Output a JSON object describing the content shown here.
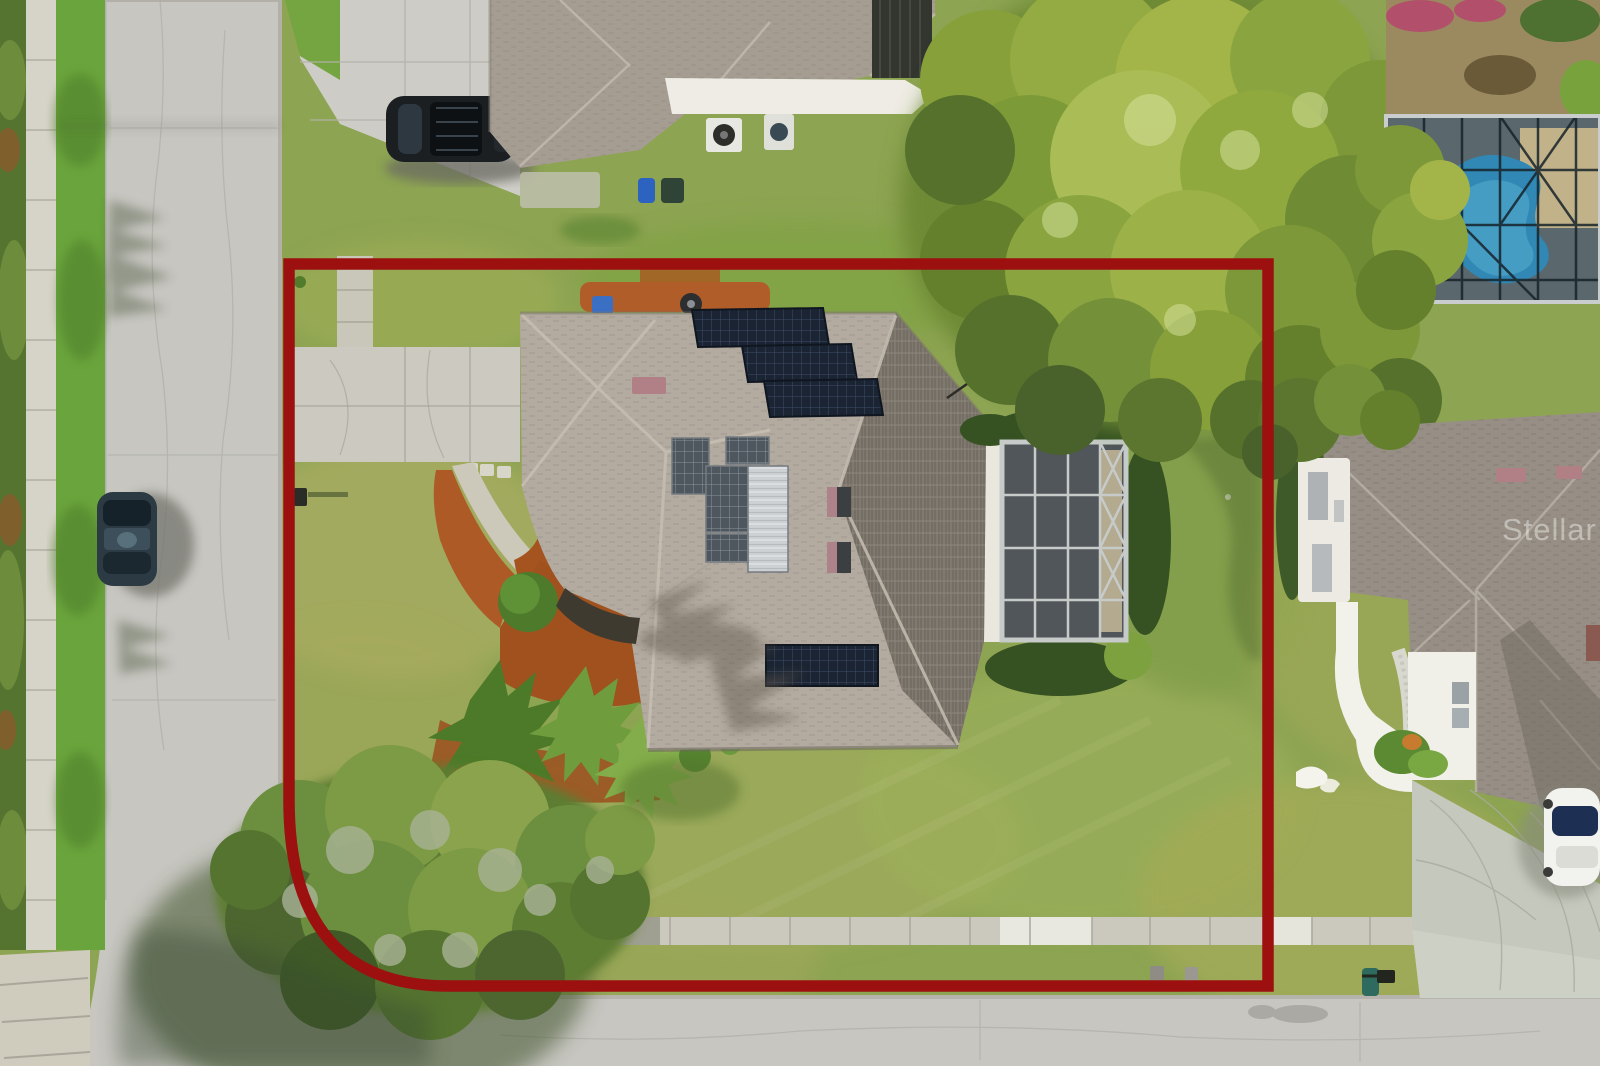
{
  "image": {
    "kind": "aerial-drone-photograph",
    "subject": "residential corner lot with highlighted property boundary",
    "width_px": 1600,
    "height_px": 1066
  },
  "watermark": {
    "text": "Stellar MLS",
    "color": "rgba(255,255,255,0.40)"
  },
  "boundary": {
    "color": "#9c1010",
    "thickness_px": 11,
    "shape": "rectangle with rounded bottom-left corner"
  },
  "palette": {
    "road": "#c7c6c1",
    "sidewalk": "#d6d4c8",
    "lawn": "#8da452",
    "bright_grass": "#6aa43c",
    "roof_light": "#b3aba0",
    "roof_dark_slope": "#80796f",
    "neighbor_roof": "#978f85",
    "solar_panel": "#1b2432",
    "silver_panel": "#ccd0d3",
    "mulch": "#ad5a26",
    "pool_water": "#3188b4",
    "screen_enclosure": "#50565a",
    "tree_canopy": "#87a03a",
    "white_walls": "#eeece4"
  },
  "features": {
    "streets": [
      "vertical street on left",
      "horizontal street at bottom"
    ],
    "subject_lot": [
      "gray hip roof house",
      "rooftop solar panel arrays",
      "silver pool-heater panels",
      "screened lanai",
      "concrete driveway",
      "curved entry walkway",
      "red mulch beds with palms",
      "large oak tree at street corner",
      "public sidewalk along bottom"
    ],
    "neighbors": [
      "house with black SUV in driveway (top)",
      "house with screened pool (top right)",
      "white house with curved walkway, white car and deer lawn ornament (right)"
    ],
    "street_objects": [
      "dark parked car on left street",
      "mailbox at driveway",
      "trash bins",
      "utility boxes"
    ]
  }
}
